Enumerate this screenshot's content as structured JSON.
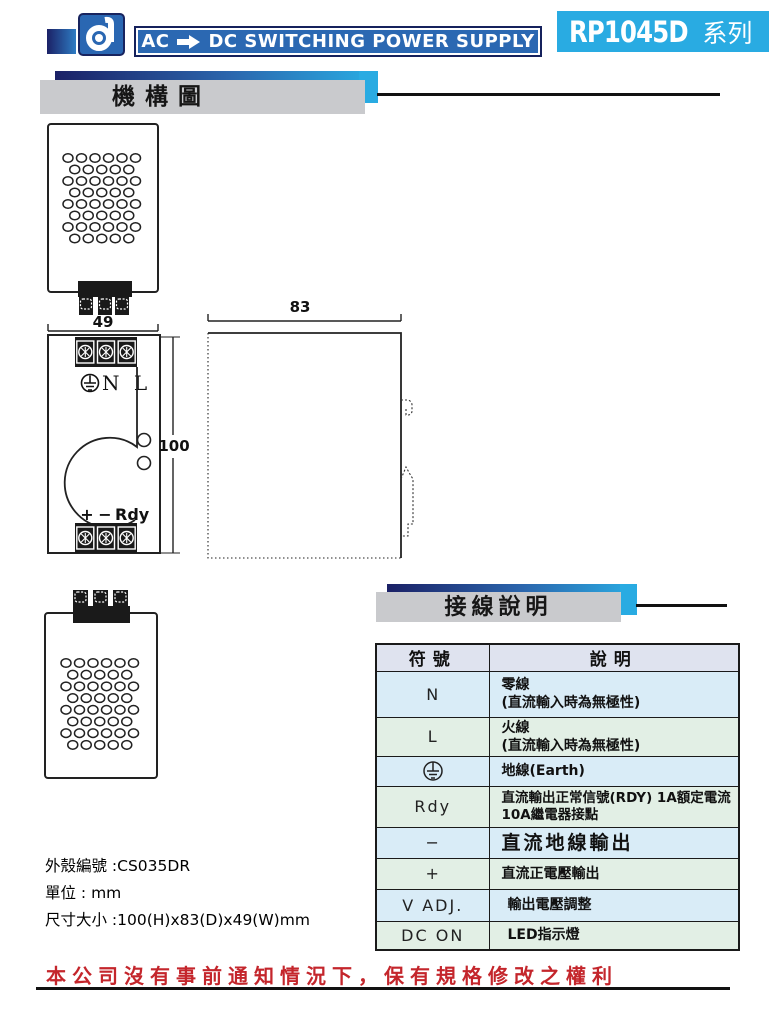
{
  "header": {
    "banner_prefix": "AC",
    "banner_suffix": "DC SWITCHING POWER SUPPLY",
    "arrow_icon": "right-arrow-icon",
    "series_model": "RP1045D",
    "series_suffix": "系列"
  },
  "sections": {
    "mechanism_title": "機構圖",
    "wiring_title": "接線說明"
  },
  "drawings": {
    "top_view_width": "49",
    "side_view_depth": "83",
    "front_view_height": "100",
    "ac_terminals_label": "N L",
    "dc_plus_label": "+",
    "dc_minus_label": "−",
    "dc_rdy_label": "Rdy",
    "earth_icon": "earth-ground-icon"
  },
  "table": {
    "headers": [
      "符號",
      "說明"
    ],
    "rows": [
      {
        "symbol": "N",
        "desc": "零線",
        "desc2": "(直流輸入時為無極性)"
      },
      {
        "symbol": "L",
        "desc": "火線",
        "desc2": "(直流輸入時為無極性)"
      },
      {
        "symbol_icon": "earth-ground-icon",
        "desc": "地線(Earth)"
      },
      {
        "symbol": "Rdy",
        "desc": "直流輸出正常信號(RDY)  1A額定電流",
        "desc2": "10A繼電器接點"
      },
      {
        "symbol": "−",
        "desc": "直流地線輸出"
      },
      {
        "symbol": "+",
        "desc": "直流正電壓輸出"
      },
      {
        "symbol": "V ADJ.",
        "desc": "輸出電壓調整"
      },
      {
        "symbol": "DC ON",
        "desc": "LED指示燈"
      }
    ]
  },
  "notes": {
    "case_no": "外殼編號 :CS035DR",
    "unit": "單位 : mm",
    "size": "尺寸大小 :100(H)x83(D)x49(W)mm"
  },
  "footer": {
    "disclaimer": "本公司沒有事前通知情況下，保有規格修改之權利"
  },
  "colors": {
    "navy": "#1b2166",
    "banner_blue": "#2b68b2",
    "cyan": "#29abe2",
    "section_gray": "#c9cacd",
    "table_header_bg": "#dfe3ef",
    "table_blue_row": "#d9ecf7",
    "table_green_row": "#e2efe5",
    "disclaimer_red": "#c4262c"
  }
}
